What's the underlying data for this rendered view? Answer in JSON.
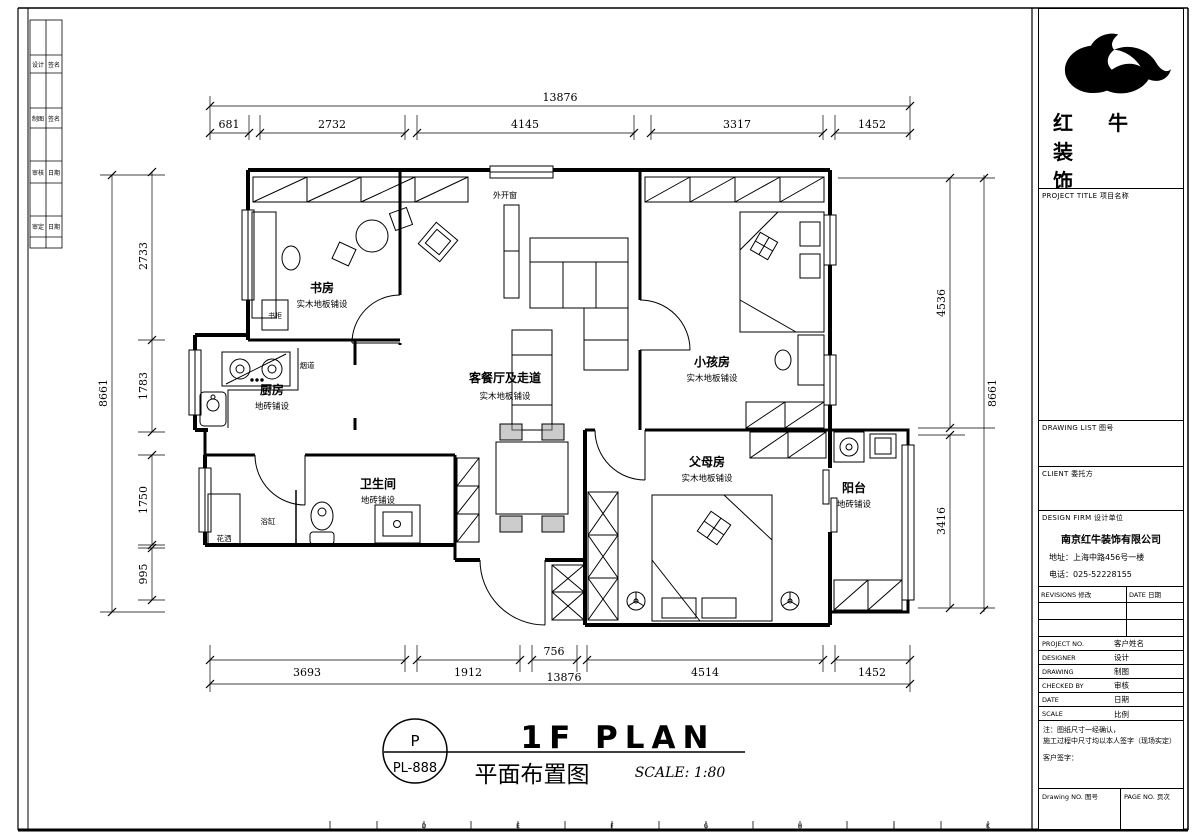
{
  "logo": {
    "line1": "红 牛 装",
    "line2": "饰"
  },
  "title_block": {
    "project_title": "PROJECT TITLE  项目名称",
    "drawing_list": "DRAWING LIST  图号",
    "client": "CLIENT  委托方",
    "design_firm": "DESIGN FIRM  设计单位",
    "company_name": "南京红牛装饰有限公司",
    "company_address": "地址：上海中路456号一楼",
    "company_phone": "电话：025-52228155",
    "revisions": "REVISIONS  修改",
    "revision_date": "DATE  日期",
    "rows": [
      {
        "label": "PROJECT NO.",
        "value": "客户姓名"
      },
      {
        "label": "DESIGNER",
        "value": "设计"
      },
      {
        "label": "DRAWING",
        "value": "制图"
      },
      {
        "label": "CHECKED BY",
        "value": "审核"
      },
      {
        "label": "DATE",
        "value": "日期"
      },
      {
        "label": "SCALE",
        "value": "比例"
      }
    ],
    "notes_line1": "注：图纸尺寸一经确认，",
    "notes_line2": "施工过程中尺寸均以本人签字（现场实定）",
    "notes_line3": "客户签字：",
    "drawing_no": "Drawing NO.  图号",
    "page_no": "PAGE NO.  页次"
  },
  "signature_strip": {
    "rows": [
      {
        "left": "设计",
        "right": "签名"
      },
      {
        "left": "制图",
        "right": "签名"
      },
      {
        "left": "审核",
        "right": "日期"
      },
      {
        "left": "审定",
        "right": "日期"
      }
    ]
  },
  "plan": {
    "rooms": [
      {
        "name": "书房",
        "finish": "实木地板铺设"
      },
      {
        "name": "厨房",
        "finish": "地砖铺设"
      },
      {
        "name": "卫生间",
        "finish": "地砖铺设"
      },
      {
        "name": "客餐厅及走道",
        "finish": "实木地板铺设"
      },
      {
        "name": "小孩房",
        "finish": "实木地板铺设"
      },
      {
        "name": "父母房",
        "finish": "实木地板铺设"
      },
      {
        "name": "阳台",
        "finish": "地砖铺设"
      }
    ],
    "annotations": {
      "window": "外开窗",
      "flue": "烟道",
      "bookcase": "书柜",
      "bathtub": "浴缸",
      "shower": "花洒"
    }
  },
  "dimensions": {
    "top": {
      "total": "13876",
      "segments": [
        "681",
        "2732",
        "4145",
        "3317",
        "1452"
      ]
    },
    "bottom": {
      "total": "13876",
      "segments": [
        "3693",
        "1912",
        "756",
        "4514",
        "1452"
      ]
    },
    "left": {
      "total": "8661",
      "segments": [
        "2733",
        "1783",
        "1750",
        "995"
      ]
    },
    "right": {
      "total": "8661",
      "segments": [
        "4536",
        "3416"
      ]
    }
  },
  "footer": {
    "bubble_top": "P",
    "bubble_bottom": "PL-888",
    "title_en": "1F PLAN",
    "title_cn": "平面布置图",
    "scale": "SCALE: 1:80"
  },
  "grid_letters": [
    "D",
    "E",
    "F",
    "G",
    "H",
    "J",
    "K"
  ]
}
